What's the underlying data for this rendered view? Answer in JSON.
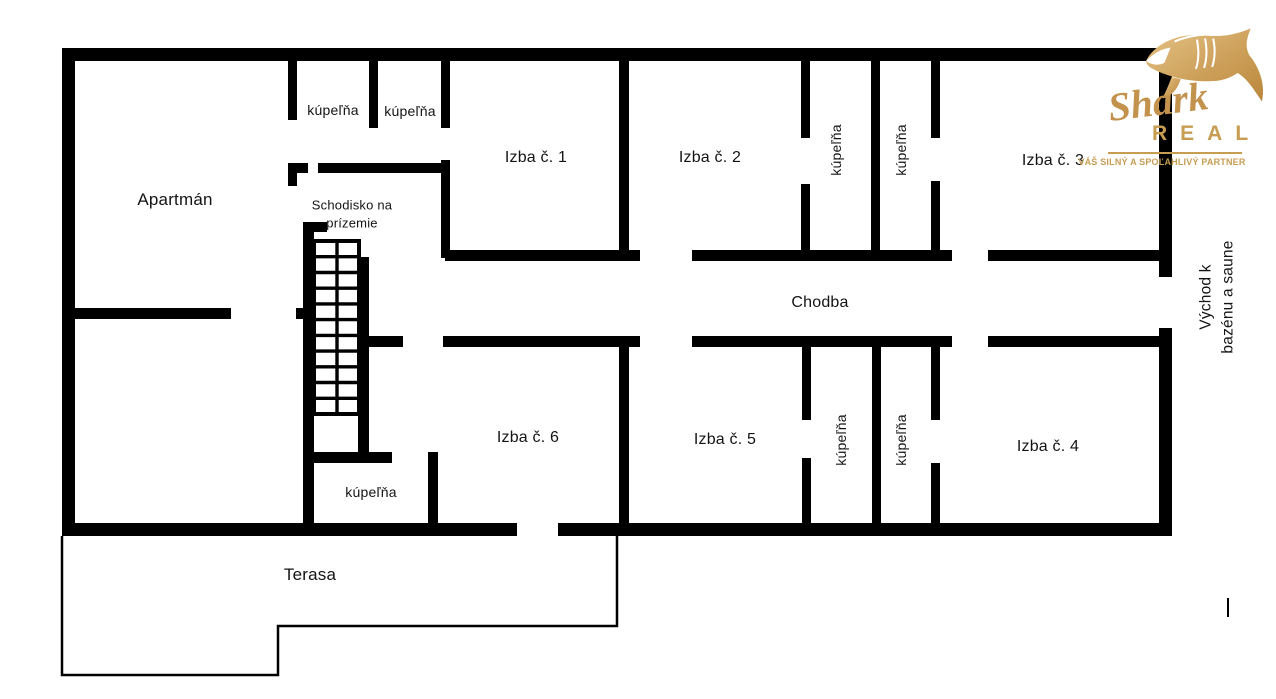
{
  "floor_plan": {
    "apartman": "Apartmán",
    "izba_1": "Izba č. 1",
    "izba_2": "Izba č. 2",
    "izba_3": "Izba č. 3",
    "izba_4": "Izba č. 4",
    "izba_5": "Izba č. 5",
    "izba_6": "Izba č. 6",
    "chodba": "Chodba",
    "terasa": "Terasa",
    "schodisko": {
      "line1": "Schodisko na",
      "line2": "prízemie"
    },
    "vychod": {
      "line1": "Východ k",
      "line2": "bazénu a saune"
    },
    "kupelna": {
      "top_left_1": "kúpeľňa",
      "top_left_2": "kúpeľňa",
      "mid_top_1": "kúpeľňa",
      "mid_top_2": "kúpeľňa",
      "mid_bottom_1": "kúpeľňa",
      "mid_bottom_2": "kúpeľňa",
      "bottom_left": "kúpeľňa"
    }
  },
  "logo": {
    "script": "Shark",
    "word": "REAL",
    "tagline": "VÁŠ SILNÝ A SPOĽAHLIVÝ PARTNER",
    "colors": {
      "gold": "#c79d52",
      "gold_light": "#e6c386",
      "gold_dark": "#b9873b"
    },
    "icon": "shark-icon"
  }
}
